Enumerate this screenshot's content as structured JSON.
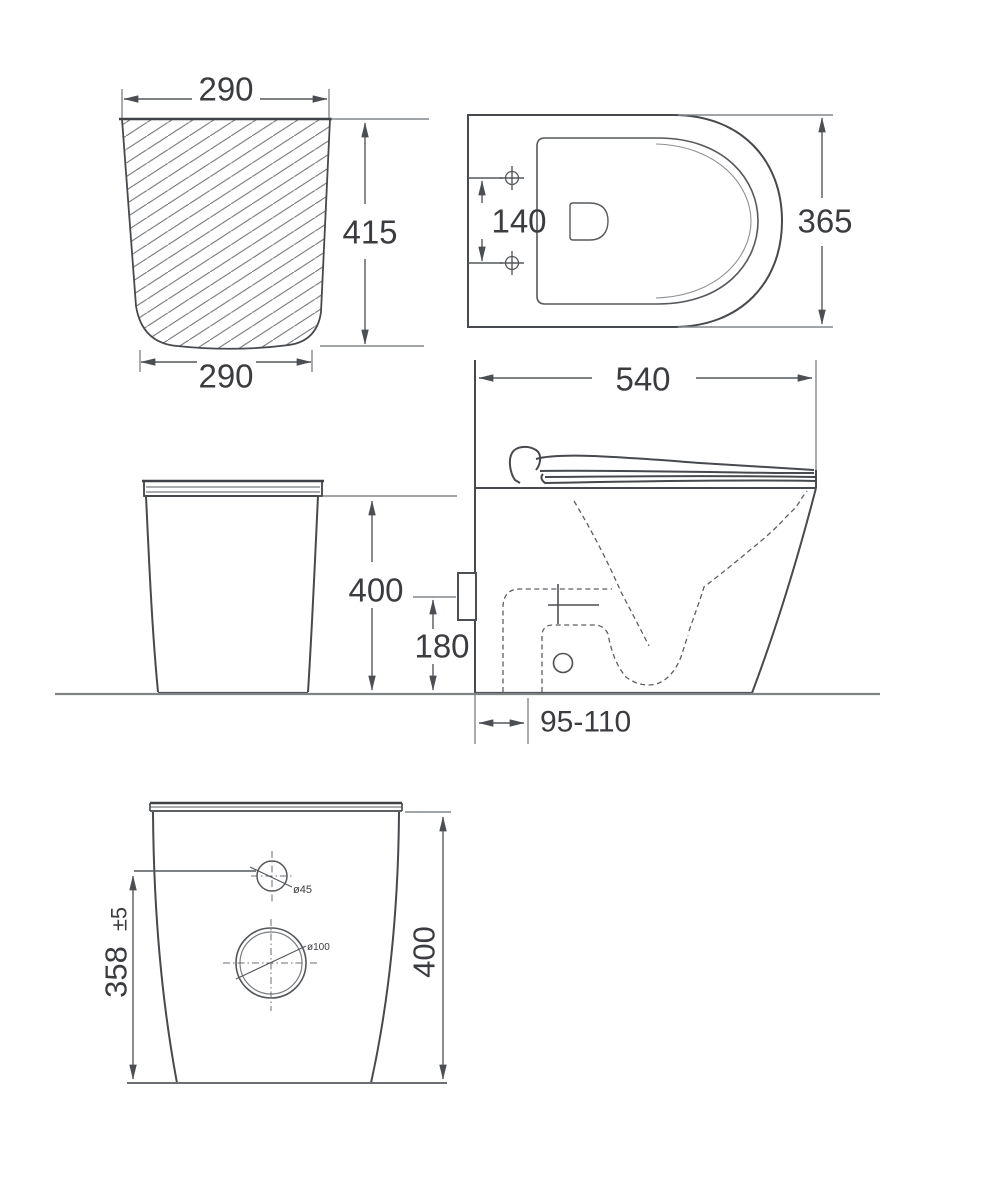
{
  "colors": {
    "line": "#46494d",
    "dimension": "#55585b",
    "text": "#3a3c40"
  },
  "views": {
    "section": {
      "top_width": "290",
      "height": "415",
      "bottom_width": "290"
    },
    "top": {
      "bolt_spacing": "140",
      "width": "365"
    },
    "side": {
      "length": "540",
      "outlet_setout": "95-110"
    },
    "front": {
      "height": "400",
      "inlet_height": "180"
    },
    "rear": {
      "hole_height": "358",
      "hole_tolerance": "±5",
      "height": "400",
      "small_hole_dia": "ø45",
      "large_hole_dia": "ø100"
    }
  }
}
